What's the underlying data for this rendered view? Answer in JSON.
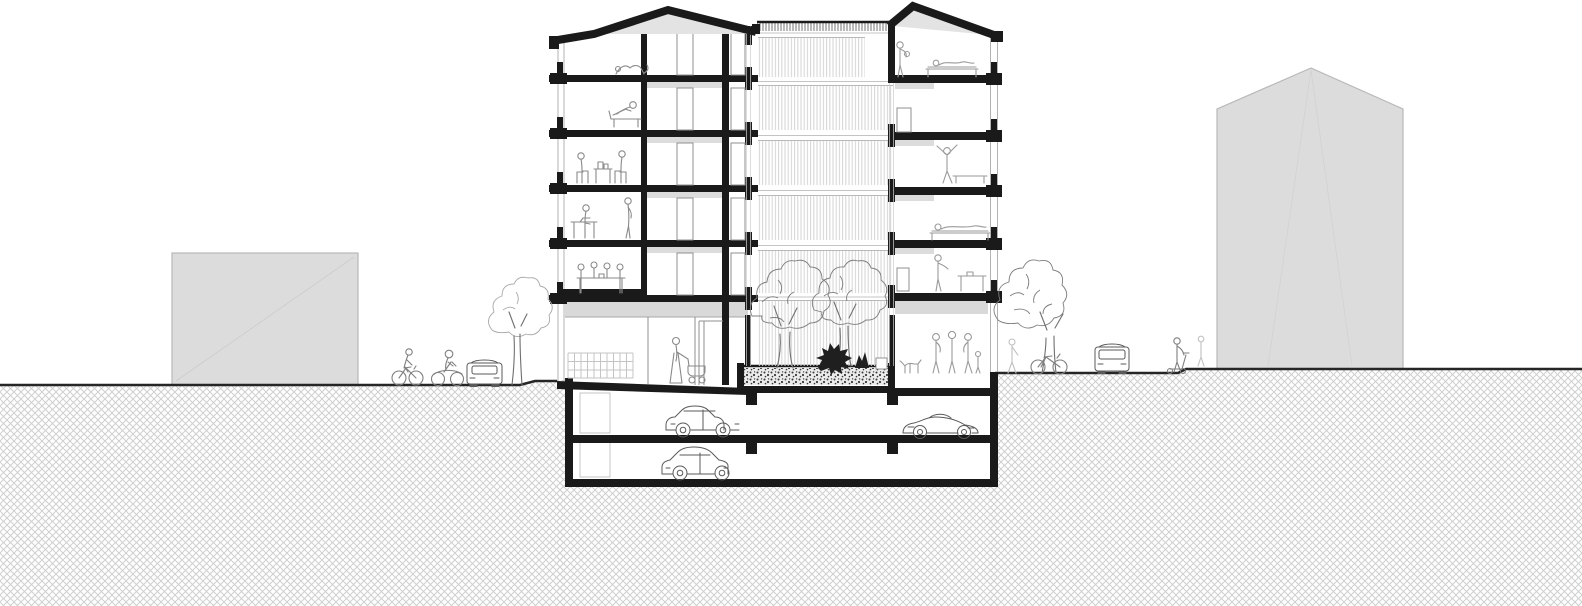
{
  "drawing": {
    "kind": "building cross-section with street context",
    "main_building": {
      "above_ground_levels": 6,
      "left_wing_scenes": [
        "cat-on-attic-floor",
        "person-on-lounge-chair",
        "two-people-at-table-with-boxes",
        "person-at-desk",
        "person-standing",
        "four-people-at-long-table",
        "shop-shelf-grid",
        "person-with-pram"
      ],
      "right_wing_scenes": [
        "person-standing-attic",
        "person-lying-on-bed-attic",
        "person-exercising",
        "person-lying-on-bed",
        "person-at-small-table",
        "dog",
        "group-of-three-people"
      ],
      "atrium": {
        "louver_bands": 6,
        "courtyard_trees": 2,
        "dark_shrubs": 2,
        "planter": "stippled planting bed over garage slab"
      }
    },
    "basement": {
      "parking_levels": 2,
      "vehicles_level_minus_1": [
        "city-car",
        "sports-car"
      ],
      "vehicles_level_minus_2": [
        "hatchback-car"
      ]
    },
    "street_left": [
      "low-gray-neighbor-building",
      "cyclist",
      "motorcyclist",
      "parked-car-front-view",
      "street-tree"
    ],
    "street_right": [
      "pedestrian-faint",
      "street-tree-with-leaning-bicycle",
      "parked-car-front-view",
      "person-with-kick-scooter",
      "pedestrian-faint",
      "tall-gabled-gray-neighbor-building"
    ]
  },
  "colors": {
    "ink": "#1a1a1a",
    "neighbor_fill": "#dcdcdc",
    "neighbor_outline": "#b8b8b8",
    "gable_fill": "#e3e3e3",
    "ceiling_fill": "#d9d9d9",
    "hatch_line": "#cfcfcf",
    "slat_line": "#d4d4d4",
    "parapet_tick": "#9c9c9c",
    "stipple_dot": "#3a3a3a",
    "stipple_bg": "#ececec",
    "ground_line": "#262626",
    "figure_line": "#8a8a8a",
    "vehicle_line": "#5a5a5a"
  }
}
